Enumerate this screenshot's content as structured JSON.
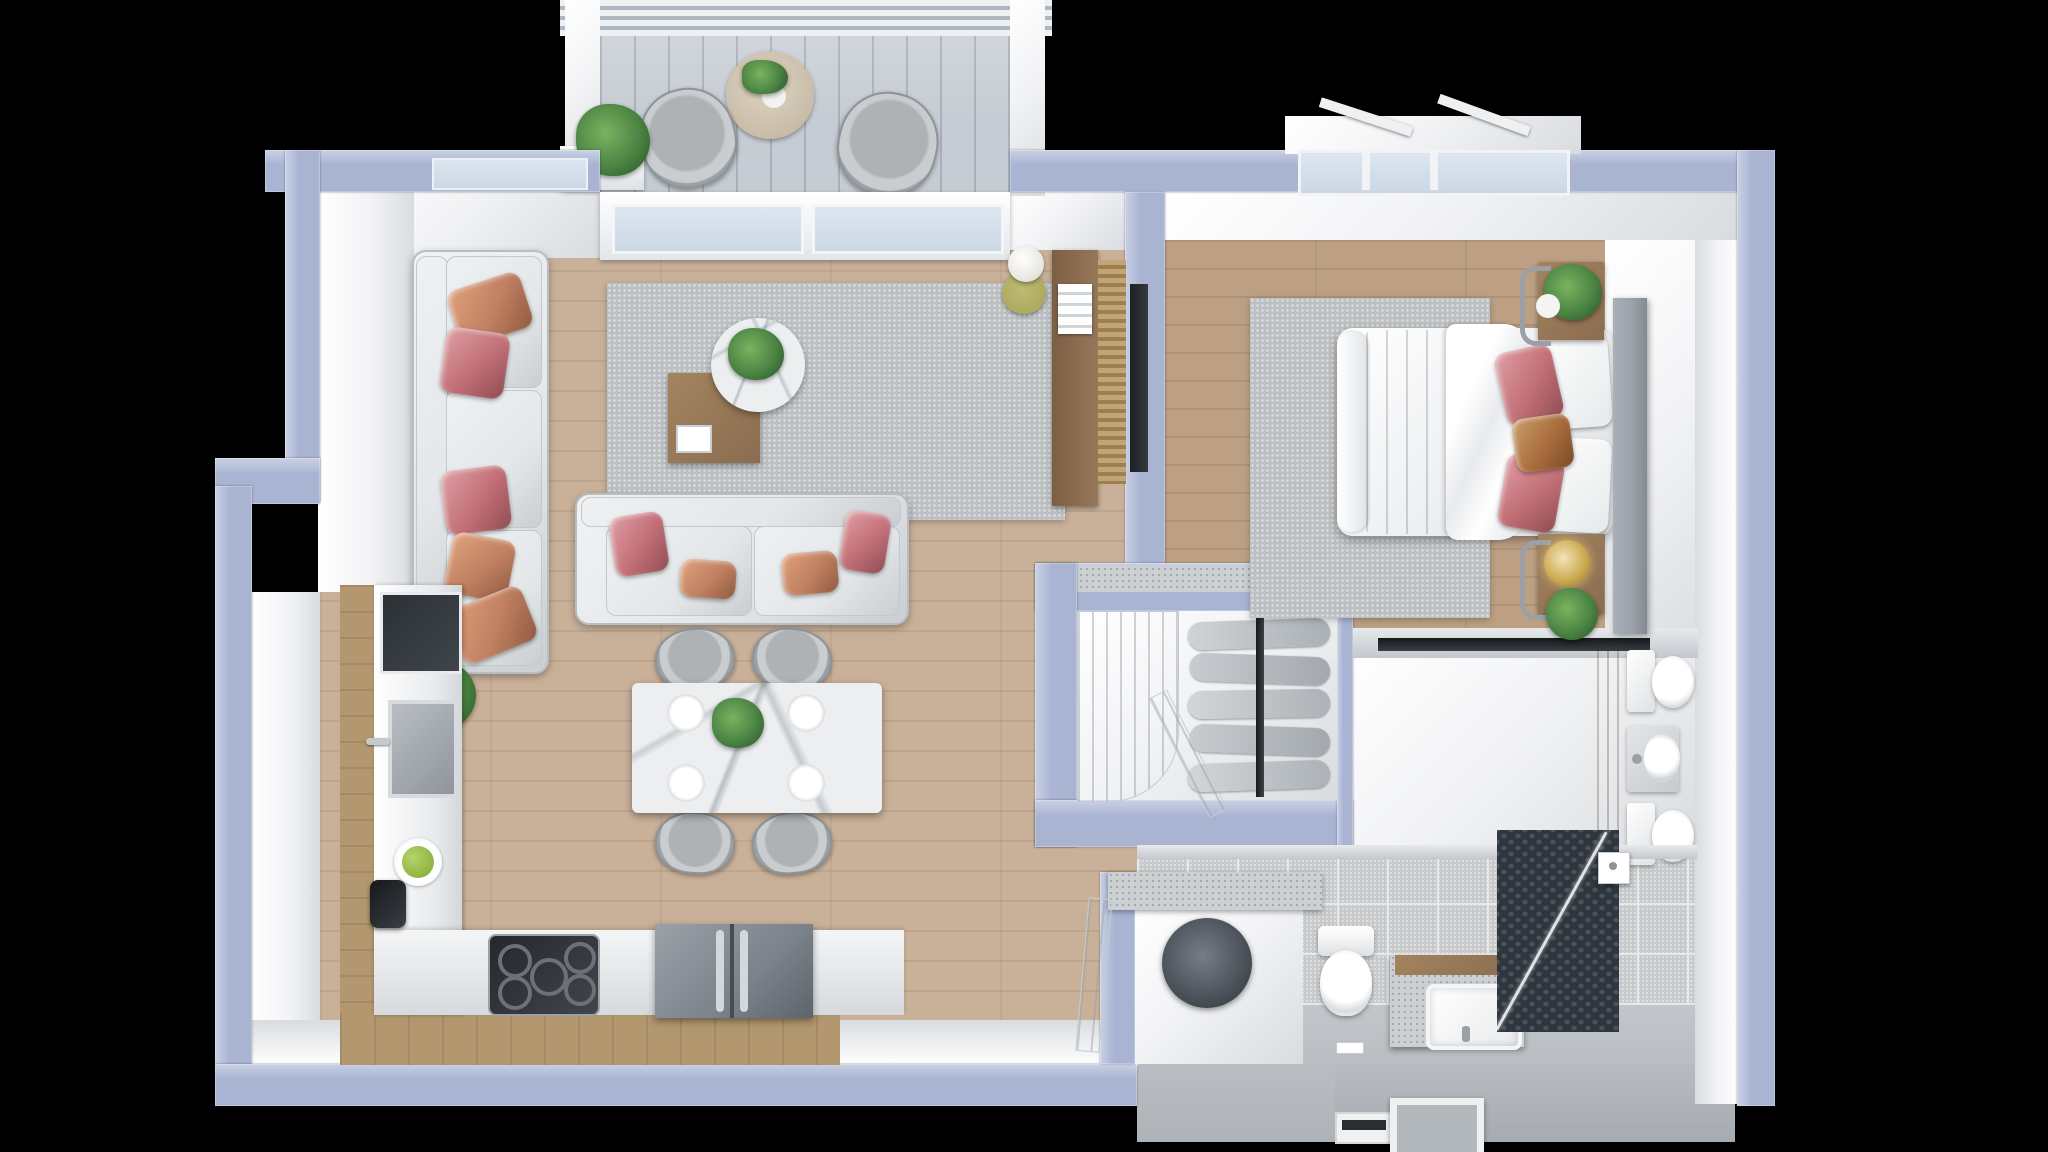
{
  "scene": {
    "type": "3d-rendered floor plan, top-down view, one-bedroom apartment",
    "width": 2048,
    "height": 1152,
    "background": "#000000"
  },
  "palette": {
    "bg": "#000000",
    "wall": "#a9b4d3",
    "wallLight": "#cad1e4",
    "wallDark": "#8d99bd",
    "face": "#f2f3f5",
    "faceShade": "#d9dcdf",
    "woodLiving": "#c9b199",
    "woodBedroom": "#bda084",
    "woodCabinet": "#b2976f",
    "woodDark": "#8a6c4f",
    "deck": "#c6ccd3",
    "rug": "#bdc0c2",
    "sofa": "#e4e7e9",
    "sofaShade": "#c9ced2",
    "pillowCopper": "#c08061",
    "pillowRose": "#c26f76",
    "pillowCaramel": "#a96c3e",
    "marble": "#eceeef",
    "plant": "#4b8443",
    "plantDark": "#2f5e2c",
    "applianceDark": "#3f454c",
    "fridge": "#7b828a",
    "tile": "#c7c9cb",
    "grout": "#e8e9ea",
    "hex": "#2f363d",
    "hexDot": "#4a525b",
    "glass": "#ccd7e6",
    "gold": "#c9a84c",
    "olive": "#a6a455",
    "steel": "#9aa0a8",
    "stone": "#ccd0d3",
    "white": "#ffffff"
  },
  "rooms": {
    "balcony": {
      "label": "Balcony"
    },
    "living": {
      "label": "Living Room"
    },
    "dining": {
      "label": "Dining Area"
    },
    "kitchen": {
      "label": "Kitchen"
    },
    "hallway": {
      "label": "Hallway / Wardrobe"
    },
    "bedroom": {
      "label": "Bedroom"
    },
    "wc": {
      "label": "Toilet Room"
    },
    "bathroom": {
      "label": "Bathroom / Laundry"
    },
    "entry": {
      "label": "Entry Vestibule"
    }
  },
  "furniture": {
    "balcony": [
      "lounge chair x2",
      "round wooden side table",
      "vase with plant",
      "planter with grass plant",
      "sliding glass door",
      "louvered railing"
    ],
    "living": [
      "three-seat sofa with copper and rose pillows",
      "two-seat sofa with copper and rose pillows",
      "gray area rug",
      "round marble coffee table",
      "square wooden side table",
      "white tablet on table",
      "potted green plant",
      "floor lamp with olive shade",
      "wooden media console with books",
      "woven screen panel",
      "leaning TV panel"
    ],
    "dining": [
      "white marble dining table",
      "gray shell chair x4",
      "white plate x4",
      "green plant centerpiece"
    ],
    "kitchen": [
      "tall unit with built-in oven",
      "square sink with chrome faucet",
      "plate of green apples",
      "black coffee machine",
      "cooktop with burners",
      "double-door refrigerator",
      "white L-shaped countertop",
      "wood cabinet base"
    ],
    "hallway": [
      "open wardrobe with hanging clothes",
      "clothes rod",
      "ridged closet door",
      "door ajar",
      "sliding pocket door"
    ],
    "bedroom": [
      "double bed",
      "white duvet",
      "gray throw blanket",
      "white pillow x2",
      "rose sequin pillow x2",
      "caramel leather pillow",
      "gray upholstered headboard",
      "wooden nightstand x2",
      "gold sphere table lamp",
      "potted plant x3",
      "gray area rug",
      "paneled window"
    ],
    "wc": [
      "toilet",
      "washbasin with faucet",
      "bidet",
      "wood accent panel"
    ],
    "bathroom": [
      "washer under stone counter",
      "laundry closet",
      "toilet",
      "stone vanity with white basin",
      "walk-in shower",
      "dark hex mosaic shower floor",
      "glass shower partition",
      "shower head",
      "terrazzo tile floor"
    ],
    "entry": [
      "door threshold",
      "recessed floor mat frame"
    ]
  }
}
